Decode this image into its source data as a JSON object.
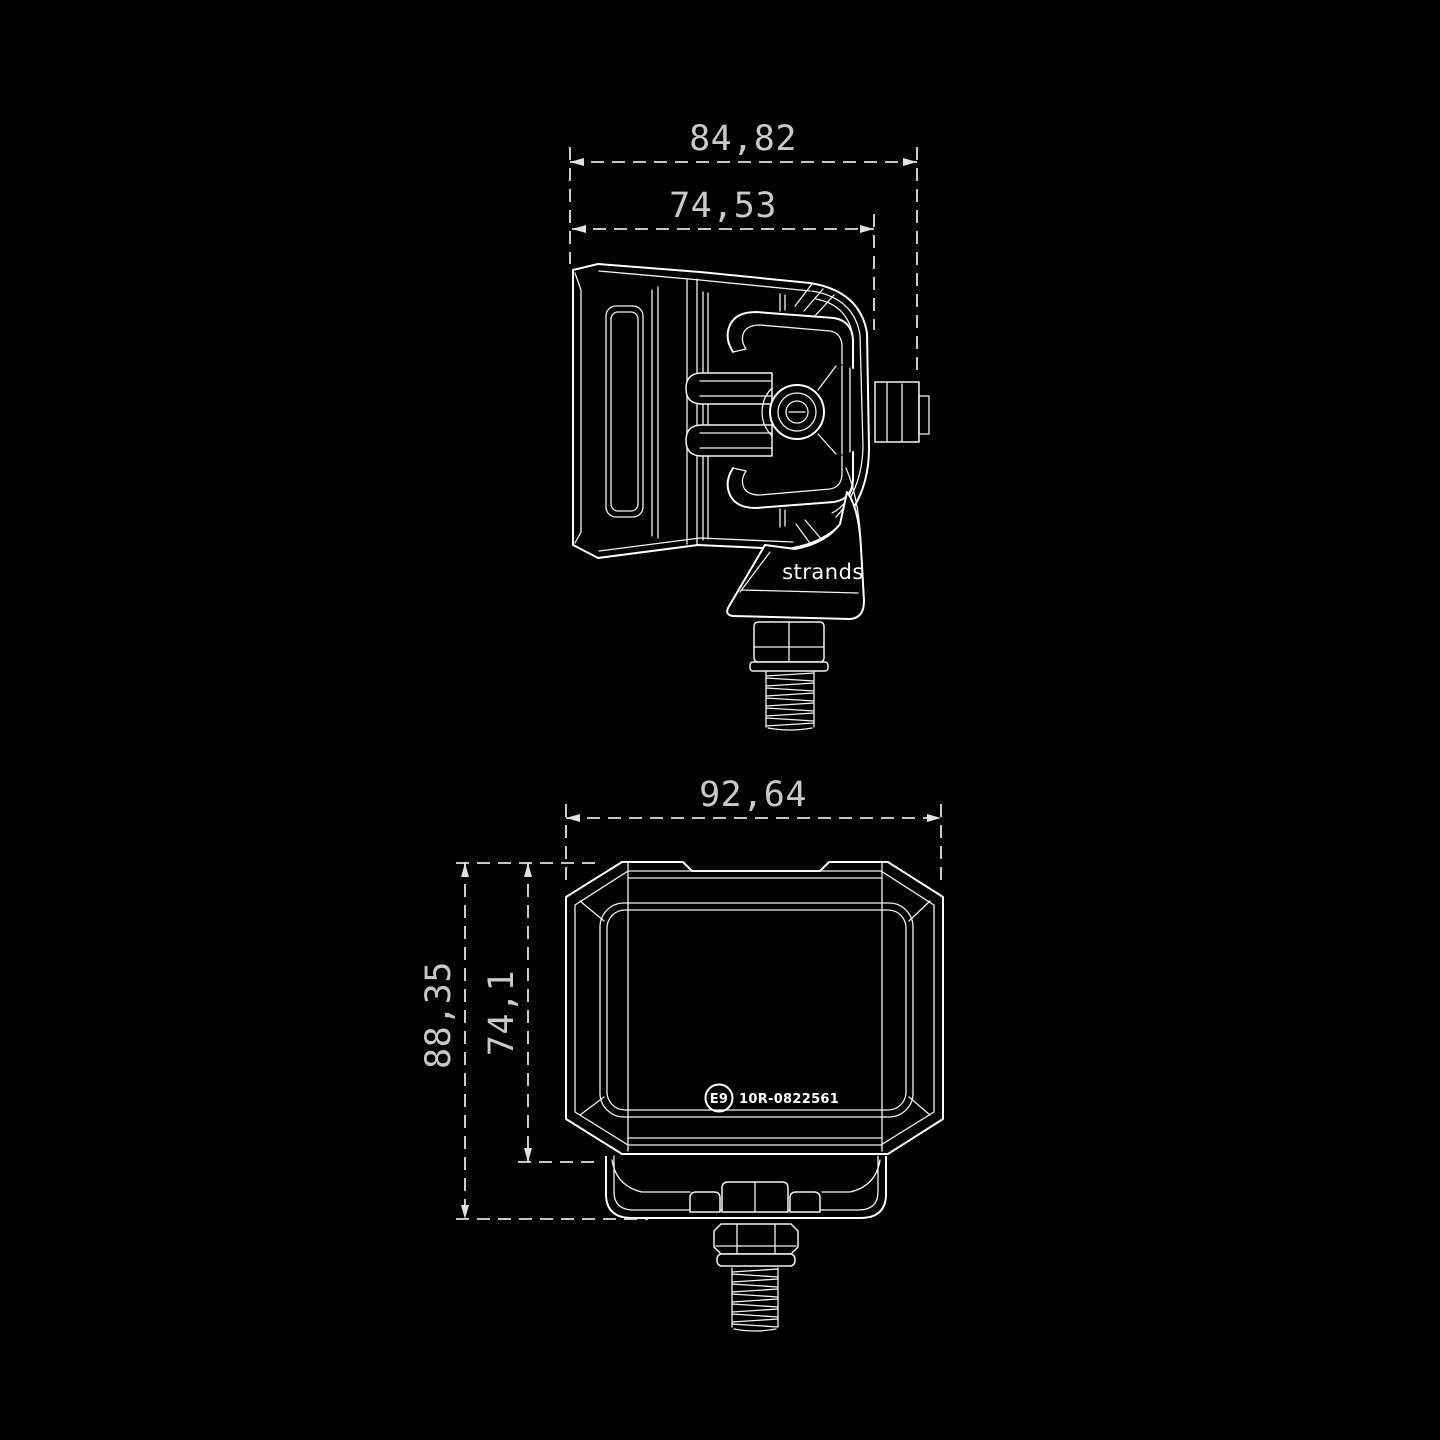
{
  "colors": {
    "background": "#000000",
    "drawing_line": "#ffffff",
    "dimension_line": "#e2e2e2",
    "dimension_text": "#c9c9c9"
  },
  "side_view": {
    "brand_label": "strands",
    "dim_overall_width": "84,82",
    "dim_lens_width": "74,53"
  },
  "front_view": {
    "approval_circle_label": "E9",
    "approval_number": "10R-0822561",
    "dim_overall_width": "92,64",
    "dim_overall_height": "88,35",
    "dim_body_height": "74,1"
  }
}
